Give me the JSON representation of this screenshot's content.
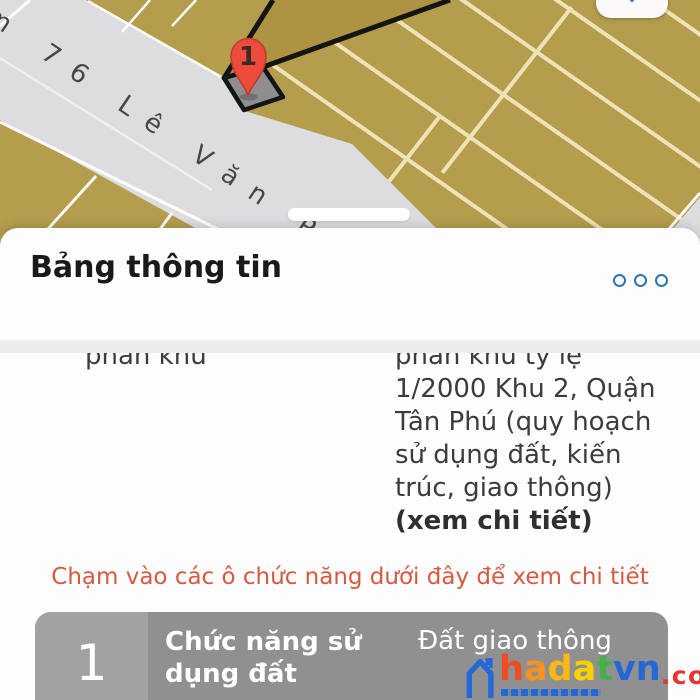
{
  "theme": {
    "gold": "#b49d4d",
    "gold-dark": "#ae9343",
    "stripe": "#eee3b6",
    "road": "#dddde0",
    "sheet": "#fdfdfd",
    "divider": "#ececec",
    "accent-blue": "#2e74ae",
    "instruction-orange": "#d65a41",
    "marker-red": "#ee4b3c",
    "marker-border": "#bf3a2c",
    "card-gray": "#909090",
    "card-index-gray": "#a2a2a2",
    "wm-blue": "#2468d6",
    "wm-red": "#e63430"
  },
  "map": {
    "street_label": "m 76 Lê Văn Phan",
    "marker_label": "1",
    "icons": {
      "map_tool": "tune-sliders-icon"
    }
  },
  "panel": {
    "title": "Bảng thông tin",
    "icons": {
      "more_options": "three-circles-icon",
      "drag_handle": "pill-handle"
    },
    "info_row": {
      "label": "phân khu",
      "value": "phân khu tỷ lệ 1/2000 Khu 2, Quận Tân Phú (quy hoạch sử dụng đất, kiến trúc, giao thông)",
      "detail_link": "(xem chi tiết)"
    },
    "instruction": "Chạm vào các ô chức năng dưới đây để xem chi tiết",
    "table": {
      "rows": [
        {
          "index": "1",
          "label": "Chức năng sử dụng đất",
          "value": "Đất giao thông"
        }
      ]
    }
  },
  "watermark": {
    "letters": [
      {
        "ch": "h",
        "color": "#ee4d23"
      },
      {
        "ch": "a",
        "color": "#f7941d"
      },
      {
        "ch": "d",
        "color": "#fcb814"
      },
      {
        "ch": "a",
        "color": "#fdd000"
      },
      {
        "ch": "t",
        "color": "#45b049"
      },
      {
        "ch": "v",
        "color": "#2468d6"
      },
      {
        "ch": "n",
        "color": "#2468d6"
      }
    ],
    "suffix": ".com.vn"
  }
}
